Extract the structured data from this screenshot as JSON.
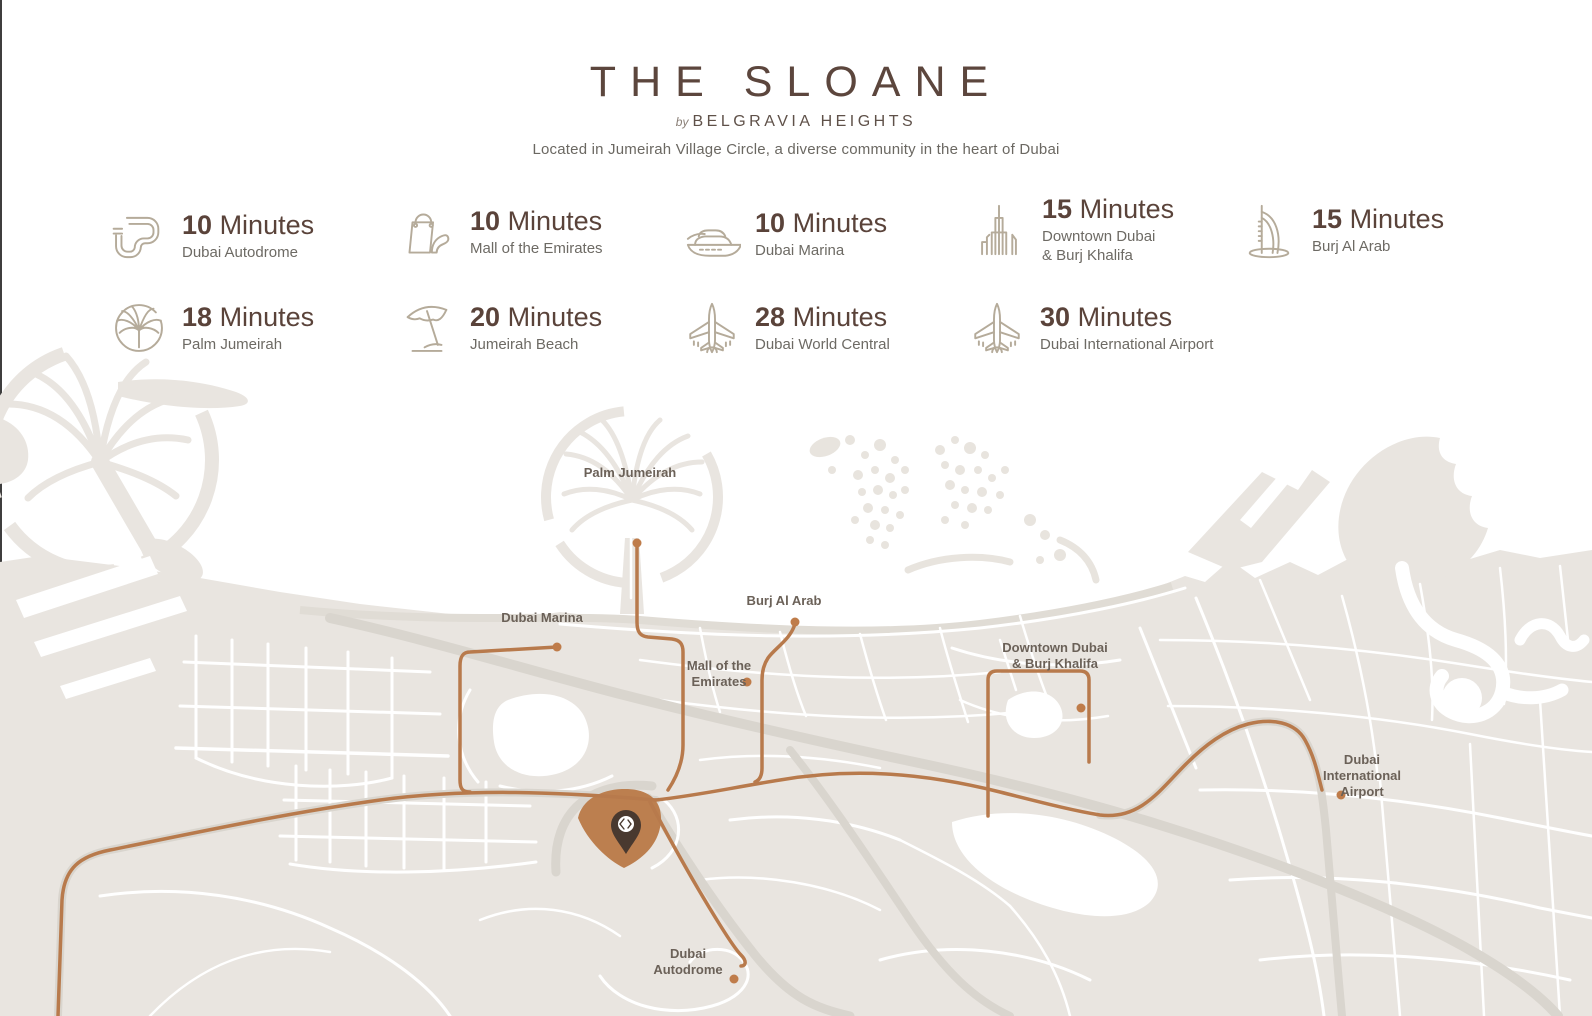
{
  "header": {
    "title": "THE SLOANE",
    "byline_prefix": "by",
    "byline_name": "BELGRAVIA HEIGHTS",
    "subtitle": "Located in Jumeirah Village Circle, a diverse community in the heart of Dubai"
  },
  "distances": [
    {
      "icon": "racetrack-icon",
      "value": "10",
      "unit": "Minutes",
      "label": "Dubai Autodrome"
    },
    {
      "icon": "shopping-icon",
      "value": "10",
      "unit": "Minutes",
      "label": "Mall of the Emirates"
    },
    {
      "icon": "yacht-icon",
      "value": "10",
      "unit": "Minutes",
      "label": "Dubai Marina"
    },
    {
      "icon": "skyline-icon",
      "value": "15",
      "unit": "Minutes",
      "label": "Downtown Dubai",
      "label2": "& Burj Khalifa"
    },
    {
      "icon": "burj-al-arab-icon",
      "value": "15",
      "unit": "Minutes",
      "label": "Burj Al Arab"
    },
    {
      "icon": "palm-island-icon",
      "value": "18",
      "unit": "Minutes",
      "label": "Palm Jumeirah"
    },
    {
      "icon": "beach-umbrella-icon",
      "value": "20",
      "unit": "Minutes",
      "label": "Jumeirah Beach"
    },
    {
      "icon": "airplane-icon",
      "value": "28",
      "unit": "Minutes",
      "label": "Dubai World Central"
    },
    {
      "icon": "airplane-icon",
      "value": "30",
      "unit": "Minutes",
      "label": "Dubai International Airport"
    }
  ],
  "map": {
    "labels": [
      {
        "line1": "Palm Jumeirah"
      },
      {
        "line1": "Dubai Marina"
      },
      {
        "line1": "Burj Al Arab"
      },
      {
        "line1": "Mall of the",
        "line2": "Emirates"
      },
      {
        "line1": "Downtown Dubai",
        "line2": "& Burj Khalifa"
      },
      {
        "line1": "Dubai",
        "line2": "International",
        "line3": "Airport"
      },
      {
        "line1": "Dubai",
        "line2": "Autodrome"
      }
    ],
    "colors": {
      "route": "#b87a4c",
      "poi_dot": "#bf7c4a",
      "land": "#e9e5e0",
      "major_road": "#d9d5ce",
      "highlight_area": "#bc7f4f",
      "pin": "#49392f",
      "label_text": "#6b6158"
    }
  }
}
